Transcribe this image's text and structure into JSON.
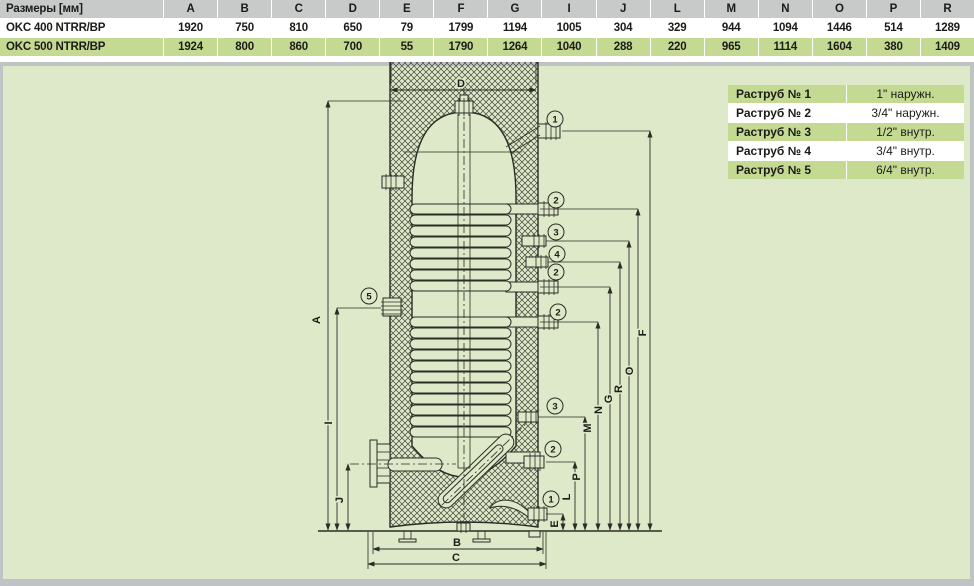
{
  "dimensions_table": {
    "corner_label": "Размеры [мм]",
    "columns": [
      "A",
      "B",
      "C",
      "D",
      "E",
      "F",
      "G",
      "I",
      "J",
      "L",
      "M",
      "N",
      "O",
      "P",
      "R"
    ],
    "rows": [
      {
        "model": "OKC 400 NTRR/BP",
        "values": [
          "1920",
          "750",
          "810",
          "650",
          "79",
          "1799",
          "1194",
          "1005",
          "304",
          "329",
          "944",
          "1094",
          "1446",
          "514",
          "1289"
        ]
      },
      {
        "model": "OKC 500 NTRR/BP",
        "values": [
          "1924",
          "800",
          "860",
          "700",
          "55",
          "1790",
          "1264",
          "1040",
          "288",
          "220",
          "965",
          "1114",
          "1604",
          "380",
          "1409"
        ]
      }
    ]
  },
  "sockets_table": {
    "rows": [
      {
        "label": "Раструб № 1",
        "value": "1\" наружн."
      },
      {
        "label": "Раструб № 2",
        "value": "3/4\" наружн."
      },
      {
        "label": "Раструб № 3",
        "value": "1/2\" внутр."
      },
      {
        "label": "Раструб № 4",
        "value": "3/4\" внутр."
      },
      {
        "label": "Раструб № 5",
        "value": "6/4\" внутр."
      }
    ]
  },
  "drawing": {
    "dim_labels": {
      "A": "A",
      "B": "B",
      "C": "C",
      "D": "D",
      "E": "E",
      "F": "F",
      "G": "G",
      "I": "I",
      "J": "J",
      "L": "L",
      "M": "M",
      "N": "N",
      "O": "O",
      "P": "P",
      "R": "R"
    },
    "callouts": {
      "n1": "1",
      "n2": "2",
      "n3": "3",
      "n4": "4",
      "n5": "5"
    },
    "colors": {
      "panel_bg": "#dde9c8",
      "row_green": "#c4da92",
      "header_grey": "#c7cac9",
      "line": "#2c2c26"
    }
  }
}
